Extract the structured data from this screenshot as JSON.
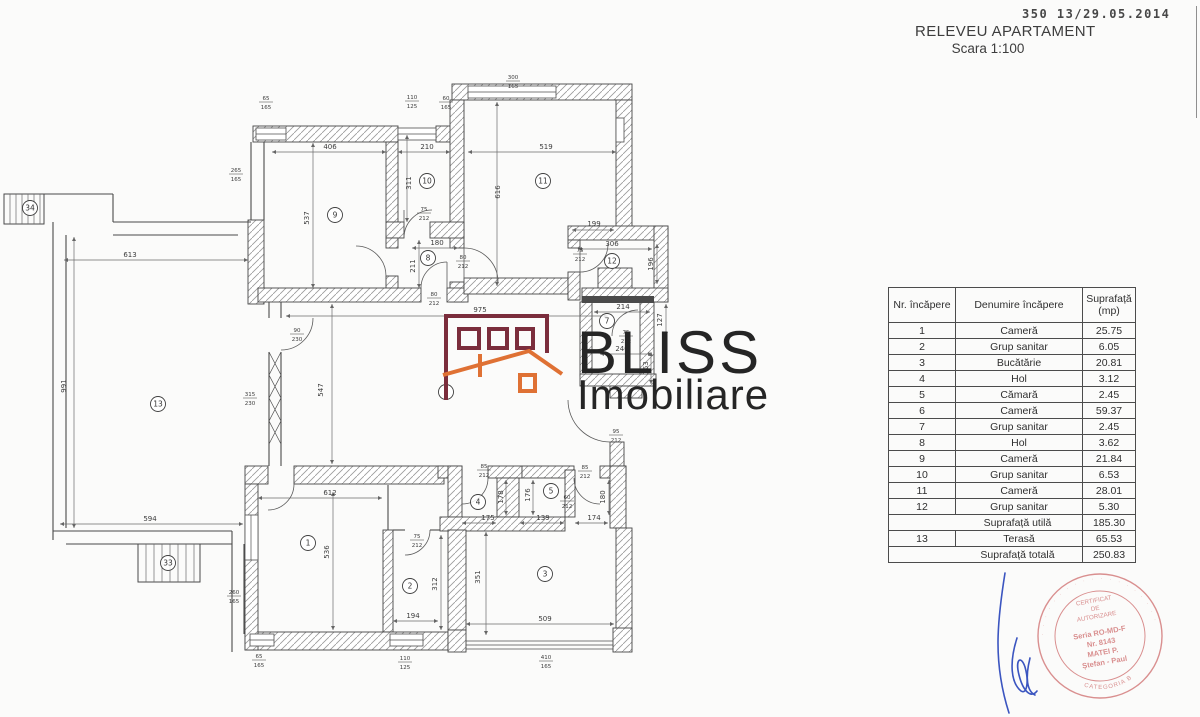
{
  "colors": {
    "paper": "#fbfbfa",
    "ink": "#3a3a3a",
    "logo_maroon": "#7b2d3c",
    "logo_orange": "#df7134",
    "logo_text": "#252525",
    "stamp_pink": "#d98f8f",
    "signature_blue": "#3b55c0"
  },
  "header": {
    "stamp_number": "350 13/29.05.2014",
    "title": "RELEVEU APARTAMENT",
    "subtitle": "Scara 1:100"
  },
  "table": {
    "columns": [
      "Nr. încăpere",
      "Denumire încăpere",
      "Suprafață (mp)"
    ],
    "rows": [
      {
        "nr": "1",
        "name": "Cameră",
        "area": "25.75"
      },
      {
        "nr": "2",
        "name": "Grup sanitar",
        "area": "6.05"
      },
      {
        "nr": "3",
        "name": "Bucătărie",
        "area": "20.81"
      },
      {
        "nr": "4",
        "name": "Hol",
        "area": "3.12"
      },
      {
        "nr": "5",
        "name": "Cămară",
        "area": "2.45"
      },
      {
        "nr": "6",
        "name": "Cameră",
        "area": "59.37"
      },
      {
        "nr": "7",
        "name": "Grup sanitar",
        "area": "2.45"
      },
      {
        "nr": "8",
        "name": "Hol",
        "area": "3.62"
      },
      {
        "nr": "9",
        "name": "Cameră",
        "area": "21.84"
      },
      {
        "nr": "10",
        "name": "Grup sanitar",
        "area": "6.53"
      },
      {
        "nr": "11",
        "name": "Cameră",
        "area": "28.01"
      },
      {
        "nr": "12",
        "name": "Grup sanitar",
        "area": "5.30"
      },
      {
        "nr": "",
        "name": "Suprafață utilă",
        "area": "185.30",
        "merged": true
      },
      {
        "nr": "13",
        "name": "Terasă",
        "area": "65.53"
      },
      {
        "nr": "",
        "name": "Suprafață totală",
        "area": "250.83",
        "merged": true
      }
    ]
  },
  "logo": {
    "word1": "BLISS",
    "word2": "Imobiliare"
  },
  "stamp": {
    "top1": "CERTIFICAT",
    "top2": "DE",
    "top3": "AUTORIZARE",
    "line1": "Seria RO-MD-F",
    "line2": "Nr. 8143",
    "line3": "MATEI P.",
    "line4": "Ștefan - Paul",
    "bottom_arc": "CATEGORIA B"
  },
  "plan": {
    "rooms": [
      {
        "n": "1",
        "x": 308,
        "y": 543
      },
      {
        "n": "2",
        "x": 410,
        "y": 586
      },
      {
        "n": "3",
        "x": 545,
        "y": 574
      },
      {
        "n": "4",
        "x": 478,
        "y": 502
      },
      {
        "n": "5",
        "x": 551,
        "y": 491
      },
      {
        "n": "6",
        "x": 446,
        "y": 392
      },
      {
        "n": "7",
        "x": 607,
        "y": 321
      },
      {
        "n": "8",
        "x": 428,
        "y": 258
      },
      {
        "n": "9",
        "x": 335,
        "y": 215
      },
      {
        "n": "10",
        "x": 427,
        "y": 181
      },
      {
        "n": "11",
        "x": 543,
        "y": 181
      },
      {
        "n": "12",
        "x": 612,
        "y": 261
      },
      {
        "n": "13",
        "x": 158,
        "y": 404
      },
      {
        "n": "33",
        "x": 168,
        "y": 563
      },
      {
        "n": "34",
        "x": 30,
        "y": 208
      }
    ],
    "dims": [
      {
        "t": "406",
        "x": 330,
        "y": 149
      },
      {
        "t": "210",
        "x": 427,
        "y": 149
      },
      {
        "t": "519",
        "x": 546,
        "y": 149
      },
      {
        "t": "537",
        "x": 309,
        "y": 218,
        "v": 1
      },
      {
        "t": "311",
        "x": 411,
        "y": 183,
        "v": 1
      },
      {
        "t": "616",
        "x": 500,
        "y": 192,
        "v": 1
      },
      {
        "t": "180",
        "x": 437,
        "y": 245
      },
      {
        "t": "211",
        "x": 415,
        "y": 266,
        "v": 1
      },
      {
        "t": "199",
        "x": 594,
        "y": 226
      },
      {
        "t": "306",
        "x": 612,
        "y": 246
      },
      {
        "t": "196",
        "x": 653,
        "y": 264,
        "v": 1
      },
      {
        "t": "214",
        "x": 623,
        "y": 309
      },
      {
        "t": "127",
        "x": 662,
        "y": 320,
        "v": 1
      },
      {
        "t": "240",
        "x": 622,
        "y": 351
      },
      {
        "t": "163",
        "x": 648,
        "y": 368,
        "v": 1
      },
      {
        "t": "975",
        "x": 480,
        "y": 312
      },
      {
        "t": "547",
        "x": 323,
        "y": 390,
        "v": 1
      },
      {
        "t": "613",
        "x": 130,
        "y": 257
      },
      {
        "t": "991",
        "x": 66,
        "y": 386,
        "v": 1
      },
      {
        "t": "594",
        "x": 150,
        "y": 521
      },
      {
        "t": "612",
        "x": 330,
        "y": 495
      },
      {
        "t": "536",
        "x": 329,
        "y": 552,
        "v": 1
      },
      {
        "t": "194",
        "x": 413,
        "y": 618
      },
      {
        "t": "312",
        "x": 437,
        "y": 584,
        "v": 1
      },
      {
        "t": "509",
        "x": 545,
        "y": 621
      },
      {
        "t": "351",
        "x": 480,
        "y": 577,
        "v": 1
      },
      {
        "t": "175",
        "x": 488,
        "y": 520
      },
      {
        "t": "139",
        "x": 543,
        "y": 520
      },
      {
        "t": "174",
        "x": 594,
        "y": 520
      },
      {
        "t": "178",
        "x": 503,
        "y": 497,
        "v": 1
      },
      {
        "t": "176",
        "x": 530,
        "y": 495,
        "v": 1
      },
      {
        "t": "180",
        "x": 605,
        "y": 497,
        "v": 1
      }
    ],
    "fracs": [
      {
        "a": "65",
        "b": "165",
        "x": 266,
        "y": 95
      },
      {
        "a": "110",
        "b": "125",
        "x": 412,
        "y": 94
      },
      {
        "a": "60",
        "b": "165",
        "x": 446,
        "y": 95
      },
      {
        "a": "300",
        "b": "165",
        "x": 513,
        "y": 74
      },
      {
        "a": "265",
        "b": "165",
        "x": 236,
        "y": 167
      },
      {
        "a": "75",
        "b": "212",
        "x": 424,
        "y": 206
      },
      {
        "a": "80",
        "b": "212",
        "x": 463,
        "y": 254
      },
      {
        "a": "80",
        "b": "212",
        "x": 434,
        "y": 291
      },
      {
        "a": "75",
        "b": "212",
        "x": 580,
        "y": 247
      },
      {
        "a": "75",
        "b": "212",
        "x": 626,
        "y": 329
      },
      {
        "a": "95",
        "b": "212",
        "x": 616,
        "y": 428
      },
      {
        "a": "90",
        "b": "230",
        "x": 297,
        "y": 327
      },
      {
        "a": "315",
        "b": "230",
        "x": 250,
        "y": 391
      },
      {
        "a": "85",
        "b": "212",
        "x": 484,
        "y": 463
      },
      {
        "a": "85",
        "b": "212",
        "x": 585,
        "y": 464
      },
      {
        "a": "60",
        "b": "212",
        "x": 567,
        "y": 494
      },
      {
        "a": "75",
        "b": "212",
        "x": 417,
        "y": 533
      },
      {
        "a": "65",
        "b": "165",
        "x": 259,
        "y": 653
      },
      {
        "a": "110",
        "b": "125",
        "x": 405,
        "y": 655
      },
      {
        "a": "410",
        "b": "165",
        "x": 546,
        "y": 654
      },
      {
        "a": "260",
        "b": "165",
        "x": 234,
        "y": 589
      }
    ]
  }
}
